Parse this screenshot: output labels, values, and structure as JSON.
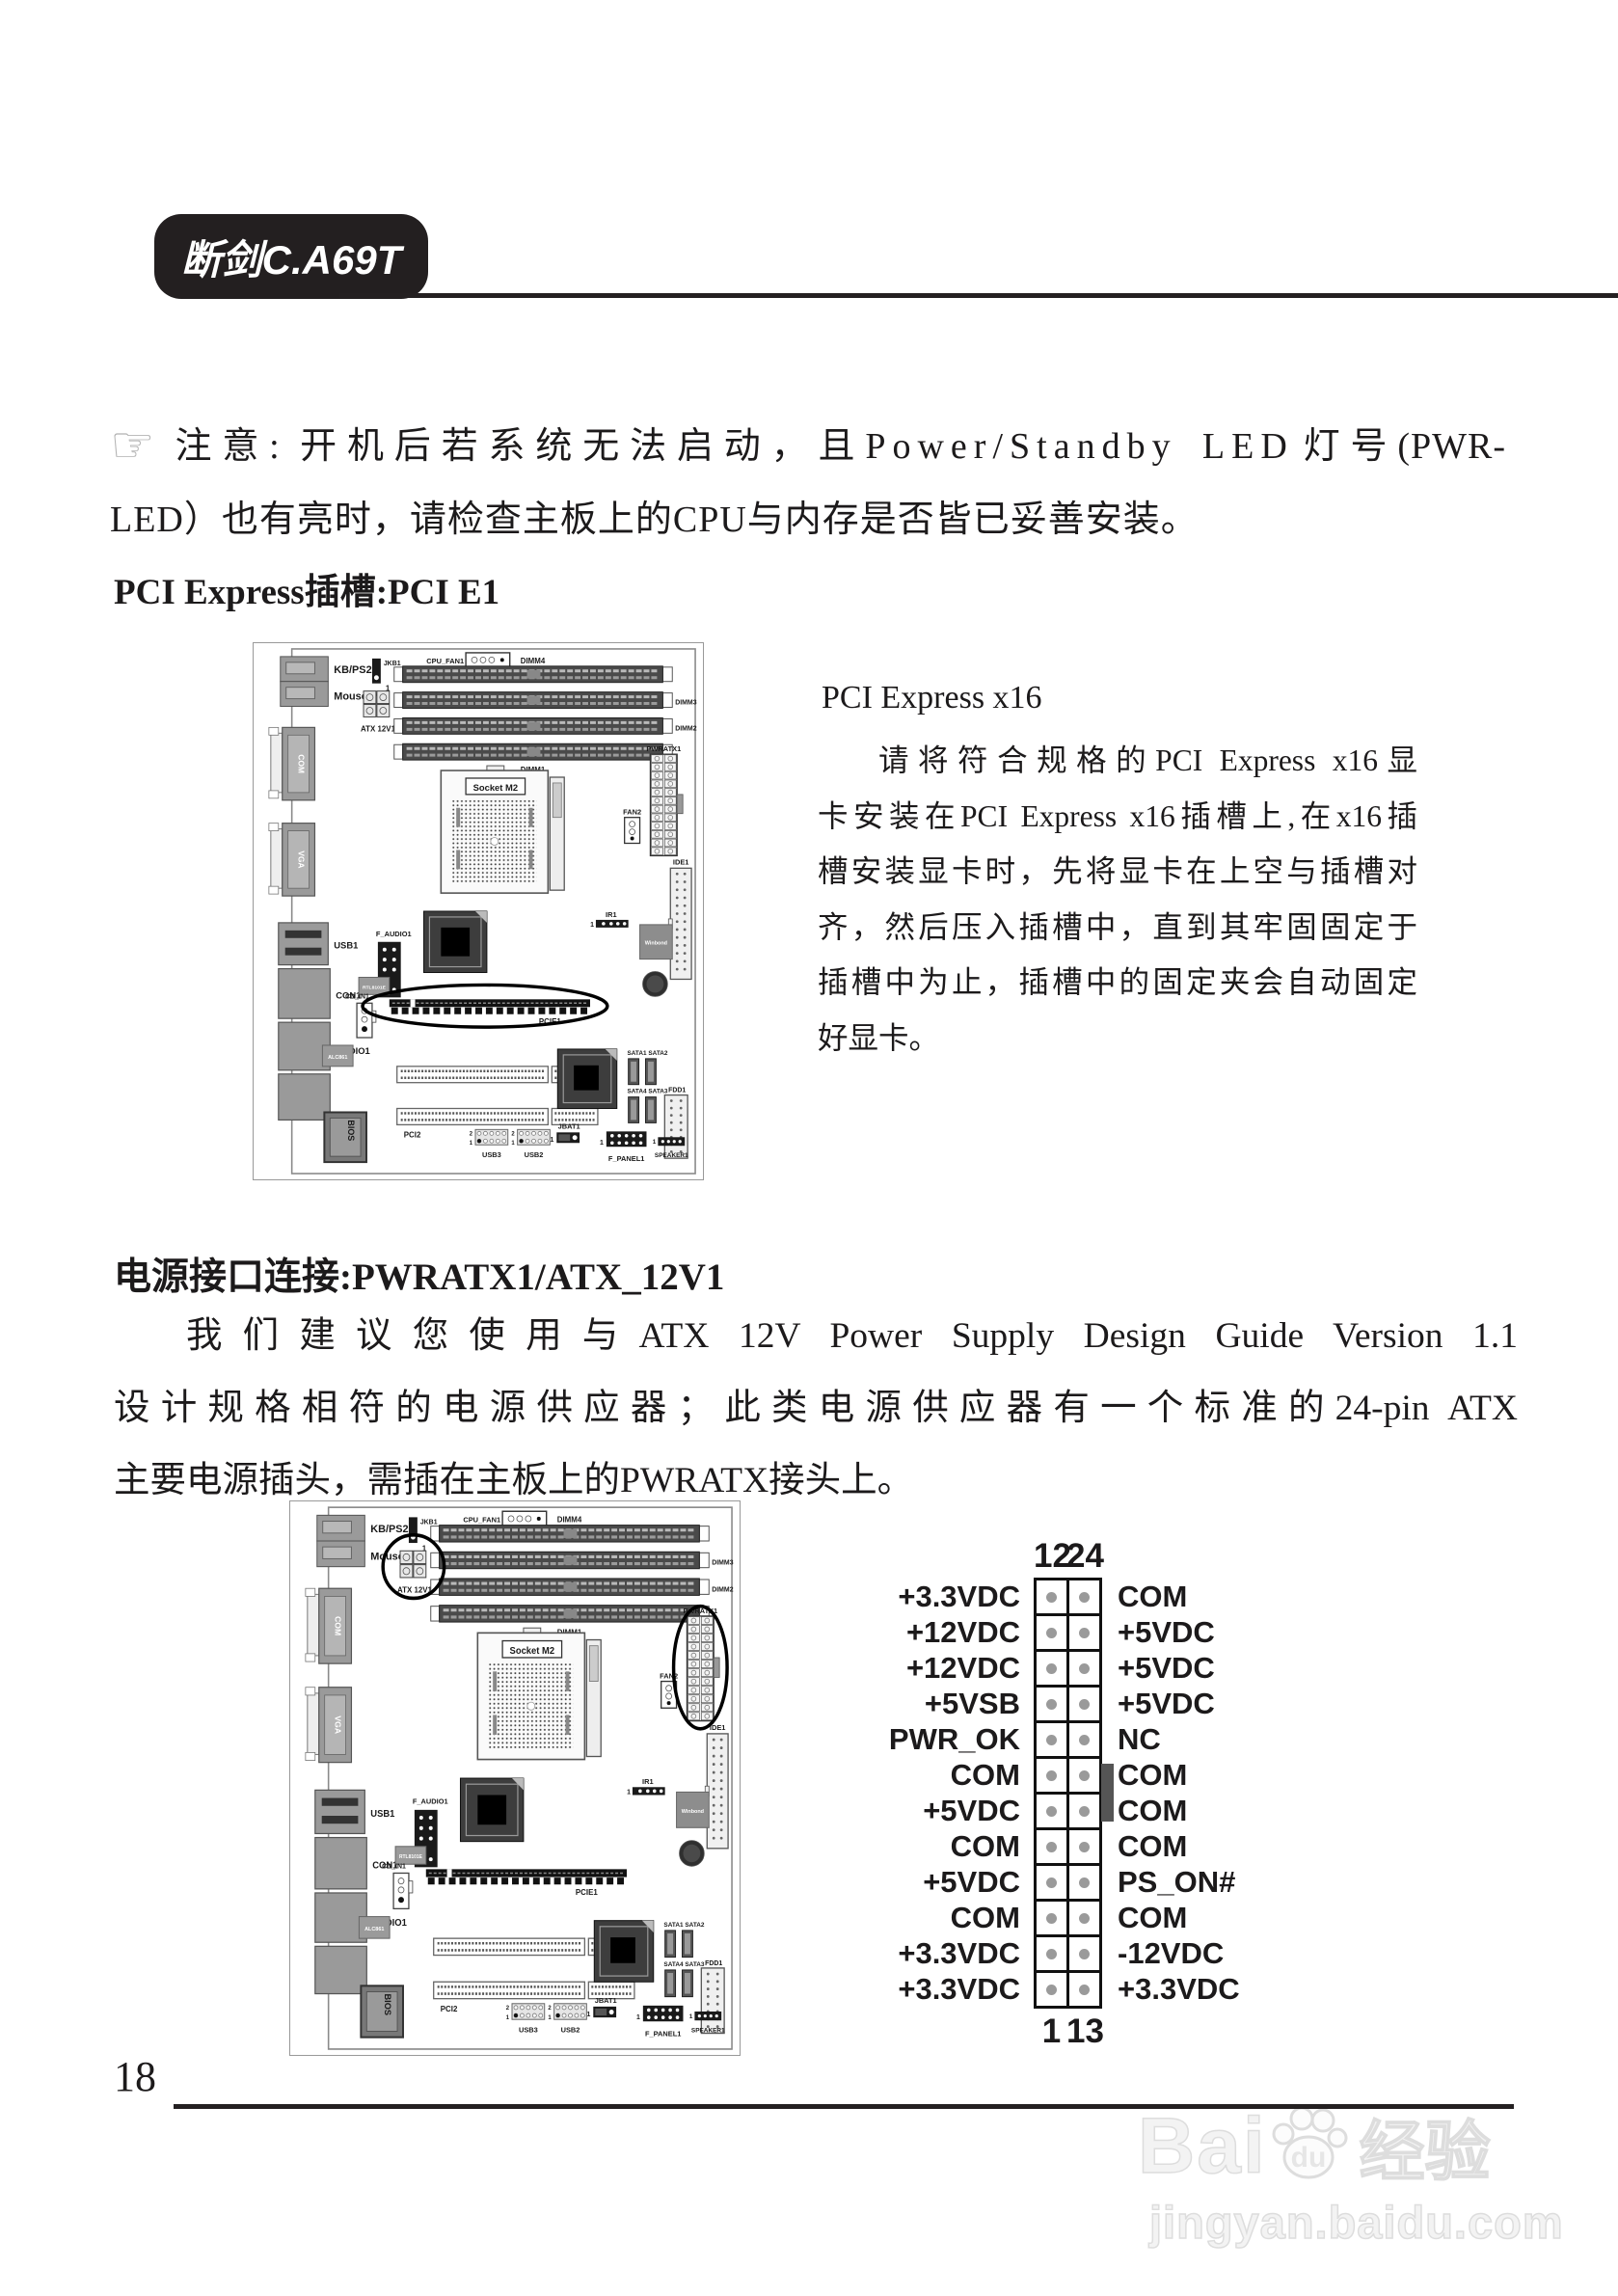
{
  "page": {
    "tab_title": "断剑C.A69T",
    "page_number": "18"
  },
  "note": {
    "hand_icon": "☞",
    "prefix": "注意: 开机后若系统无法启动，且",
    "spaced": "Power/Standby LED",
    "suffix": "灯号(PWR-",
    "line2": "LED）也有亮时，请检查主板上的CPU与内存是否皆已妥善安装。"
  },
  "pcie_section": {
    "heading": "PCI Express插槽:PCI E1",
    "subheading": "PCI Express x16",
    "body_lines": [
      "请将符合规格的PCI Express x16显",
      "卡安装在PCI Express x16插槽上,在x16插",
      "槽安装显卡时，先将显卡在上空与插槽对",
      "齐，然后压入插槽中，直到其牢固固定于",
      "插槽中为止，插槽中的固定夹会自动固定",
      "好显卡。"
    ]
  },
  "power_section": {
    "heading": "电源接口连接:PWRATX1/ATX_12V1",
    "body_lines": [
      "我们建议您使用与ATX 12V Power Supply Design Guide Version 1.1",
      "设计规格相符的电源供应器；此类电源供应器有一个标准的24-pin ATX",
      "主要电源插头，需插在主板上的PWRATX接头上。"
    ]
  },
  "board_labels": {
    "kb_ps2": "KB/PS2",
    "mouse_ps2": "Mouse/PS2",
    "jkb1": "JKB1",
    "atx_12v1": "ATX 12V1",
    "cpu_fan1": "CPU_FAN1",
    "dimm4": "DIMM4",
    "dimm3": "DIMM3",
    "dimm2": "DIMM2",
    "dimm1": "DIMM1",
    "socket": "Socket M2",
    "pwratx1": "PWRATX1",
    "fan2": "FAN2",
    "ide1": "IDE1",
    "ir1": "IR1",
    "winbond": "Winbond",
    "com": "COM",
    "vga": "VGA",
    "usb1": "USB1",
    "con1": "CON1",
    "audio1": "AUDIO1",
    "f_audio1": "F_AUDIO1",
    "rtl": "RTL8101E",
    "cd_in1": "CD_IN1",
    "alc": "ALC861",
    "pcie1": "PCIE1",
    "pci1": "PCI1",
    "pci2": "PCI2",
    "bios": "BIOS",
    "jbat1": "JBAT1",
    "usb3": "USB3",
    "usb2": "USB2",
    "f_panel1": "F_PANEL1",
    "fdd1": "FDD1",
    "speaker1": "SPEAKER1",
    "sata12": "SATA1 SATA2",
    "sata43": "SATA4 SATA3"
  },
  "pinout": {
    "top_pins": [
      "12",
      "24"
    ],
    "bottom_pins": [
      "1",
      "13"
    ],
    "rows": [
      {
        "left": "+3.3VDC",
        "right": "COM"
      },
      {
        "left": "+12VDC",
        "right": "+5VDC"
      },
      {
        "left": "+12VDC",
        "right": "+5VDC"
      },
      {
        "left": "+5VSB",
        "right": "+5VDC"
      },
      {
        "left": "PWR_OK",
        "right": "NC"
      },
      {
        "left": "COM",
        "right": "COM"
      },
      {
        "left": "+5VDC",
        "right": "COM"
      },
      {
        "left": "COM",
        "right": "COM"
      },
      {
        "left": "+5VDC",
        "right": "PS_ON#"
      },
      {
        "left": "COM",
        "right": "COM"
      },
      {
        "left": "+3.3VDC",
        "right": "-12VDC"
      },
      {
        "left": "+3.3VDC",
        "right": "+3.3VDC"
      }
    ]
  },
  "watermark": {
    "brand_prefix": "Bai",
    "brand_mid": "du",
    "brand_suffix": "经验",
    "url": "jingyan.baidu.com"
  },
  "colors": {
    "ink": "#231f20",
    "rule": "#242021"
  }
}
